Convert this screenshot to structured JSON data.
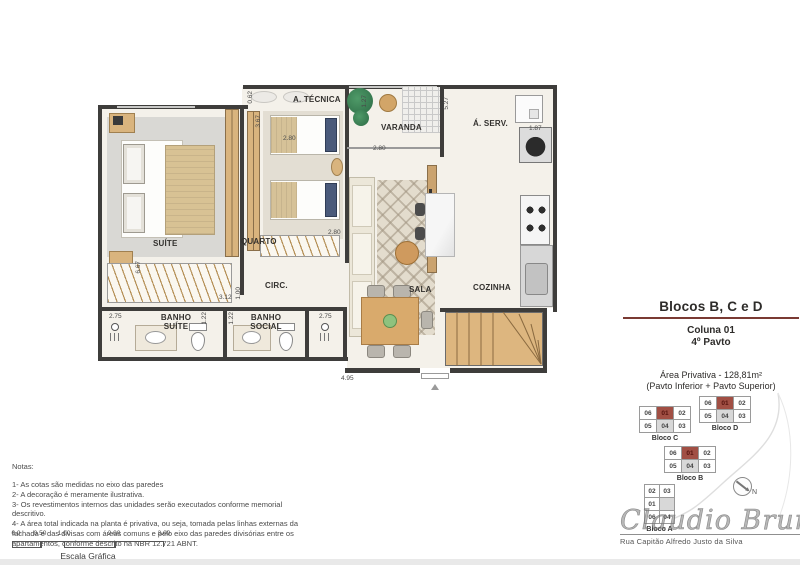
{
  "colors": {
    "accent": "#7a3a33",
    "wall": "#3e3d3b",
    "wood": "#d9b47e",
    "highlight": "#a14f44"
  },
  "panel": {
    "title": "Blocos B, C e D",
    "subtitle1": "Coluna 01",
    "subtitle2": "4º Pavto",
    "area_line1": "Área Privativa - 128,81m²",
    "area_line2": "(Pavto Inferior + Pavto Superior)",
    "signature": "Claudio Brum",
    "street": "Rua Capitão Alfredo Justo da Silva",
    "compass_label": "N"
  },
  "plan": {
    "rooms": [
      {
        "label": "SUÍTE"
      },
      {
        "label": "QUARTO"
      },
      {
        "label": "CIRC."
      },
      {
        "label": "BANHO SUÍTE"
      },
      {
        "label": "BANHO SOCIAL"
      },
      {
        "label": "SALA"
      },
      {
        "label": "COZINHA"
      },
      {
        "label": "VARANDA"
      },
      {
        "label": "A. TÉCNICA"
      },
      {
        "label": "Á. SERV."
      }
    ],
    "dims": [
      {
        "v": "0.62"
      },
      {
        "v": "3.67"
      },
      {
        "v": "1.27"
      },
      {
        "v": "2.80"
      },
      {
        "v": "2.80"
      },
      {
        "v": "5.27"
      },
      {
        "v": "1.87"
      },
      {
        "v": "2.80"
      },
      {
        "v": "3.12"
      },
      {
        "v": "1.00"
      },
      {
        "v": "1.22"
      },
      {
        "v": "1.22"
      },
      {
        "v": "2.75"
      },
      {
        "v": "2.75"
      },
      {
        "v": "6.67"
      },
      {
        "v": "4.95"
      }
    ]
  },
  "blocks": {
    "c": {
      "label": "Bloco C",
      "cells": [
        "06",
        "01",
        "02",
        "05",
        "04",
        "03"
      ]
    },
    "d": {
      "label": "Bloco D",
      "cells": [
        "06",
        "01",
        "02",
        "05",
        "04",
        "03"
      ]
    },
    "b": {
      "label": "Bloco B",
      "cells": [
        "06",
        "01",
        "02",
        "05",
        "04",
        "03"
      ]
    },
    "a": {
      "label": "Bloco A",
      "cells": [
        "02",
        "03",
        "01",
        "",
        "06",
        "04"
      ]
    }
  },
  "notes": {
    "title": "Notas:",
    "items": [
      "1- As cotas são medidas no eixo das paredes",
      "2- A decoração é meramente ilustrativa.",
      "3- Os revestimentos internos das unidades serão executados conforme memorial descritivo.",
      "4- A área total indicada na planta é privativa, ou seja, tomada pelas linhas externas da fachada e das divisas com áreas comuns e pelo eixo das paredes divisórias entre os apartamentos, conforme descrito na NBR 12.721 ABNT."
    ]
  },
  "scale": {
    "labels": [
      "0.0",
      "0.50",
      "1.00",
      "2.00",
      "3.00"
    ],
    "caption": "Escala Gráfica"
  }
}
